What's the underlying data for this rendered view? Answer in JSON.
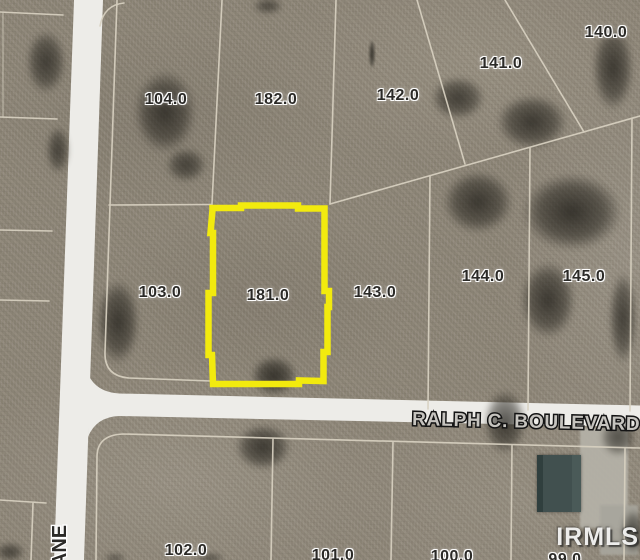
{
  "map": {
    "type": "aerial-parcel-map",
    "highlighted_parcel": "181.0",
    "parcel_labels": [
      {
        "text": "104.0",
        "x": 166,
        "y": 100
      },
      {
        "text": "182.0",
        "x": 276,
        "y": 100
      },
      {
        "text": "142.0",
        "x": 398,
        "y": 96
      },
      {
        "text": "141.0",
        "x": 501,
        "y": 64
      },
      {
        "text": "140.0",
        "x": 606,
        "y": 33
      },
      {
        "text": "103.0",
        "x": 160,
        "y": 293
      },
      {
        "text": "181.0",
        "x": 268,
        "y": 296
      },
      {
        "text": "143.0",
        "x": 375,
        "y": 293
      },
      {
        "text": "144.0",
        "x": 483,
        "y": 277
      },
      {
        "text": "145.0",
        "x": 584,
        "y": 277
      },
      {
        "text": "102.0",
        "x": 186,
        "y": 551
      },
      {
        "text": "101.0",
        "x": 333,
        "y": 556
      },
      {
        "text": "100.0",
        "x": 452,
        "y": 557
      },
      {
        "text": "99.0",
        "x": 565,
        "y": 560
      }
    ],
    "roads": {
      "horizontal_road_name": "RALPH C. BOULEVARD",
      "vertical_road_name_visible": "ANE"
    },
    "watermark": "IRMLS",
    "colors": {
      "highlight_outline": "#f2ea0e",
      "road_surface": "#edece8",
      "ground": "#8d8577",
      "parcel_line": "#d8d1c1",
      "parcel_label_color": "#2b2a27",
      "road_label_color": "#c6c4bf",
      "building_roof": "#41504f"
    }
  }
}
